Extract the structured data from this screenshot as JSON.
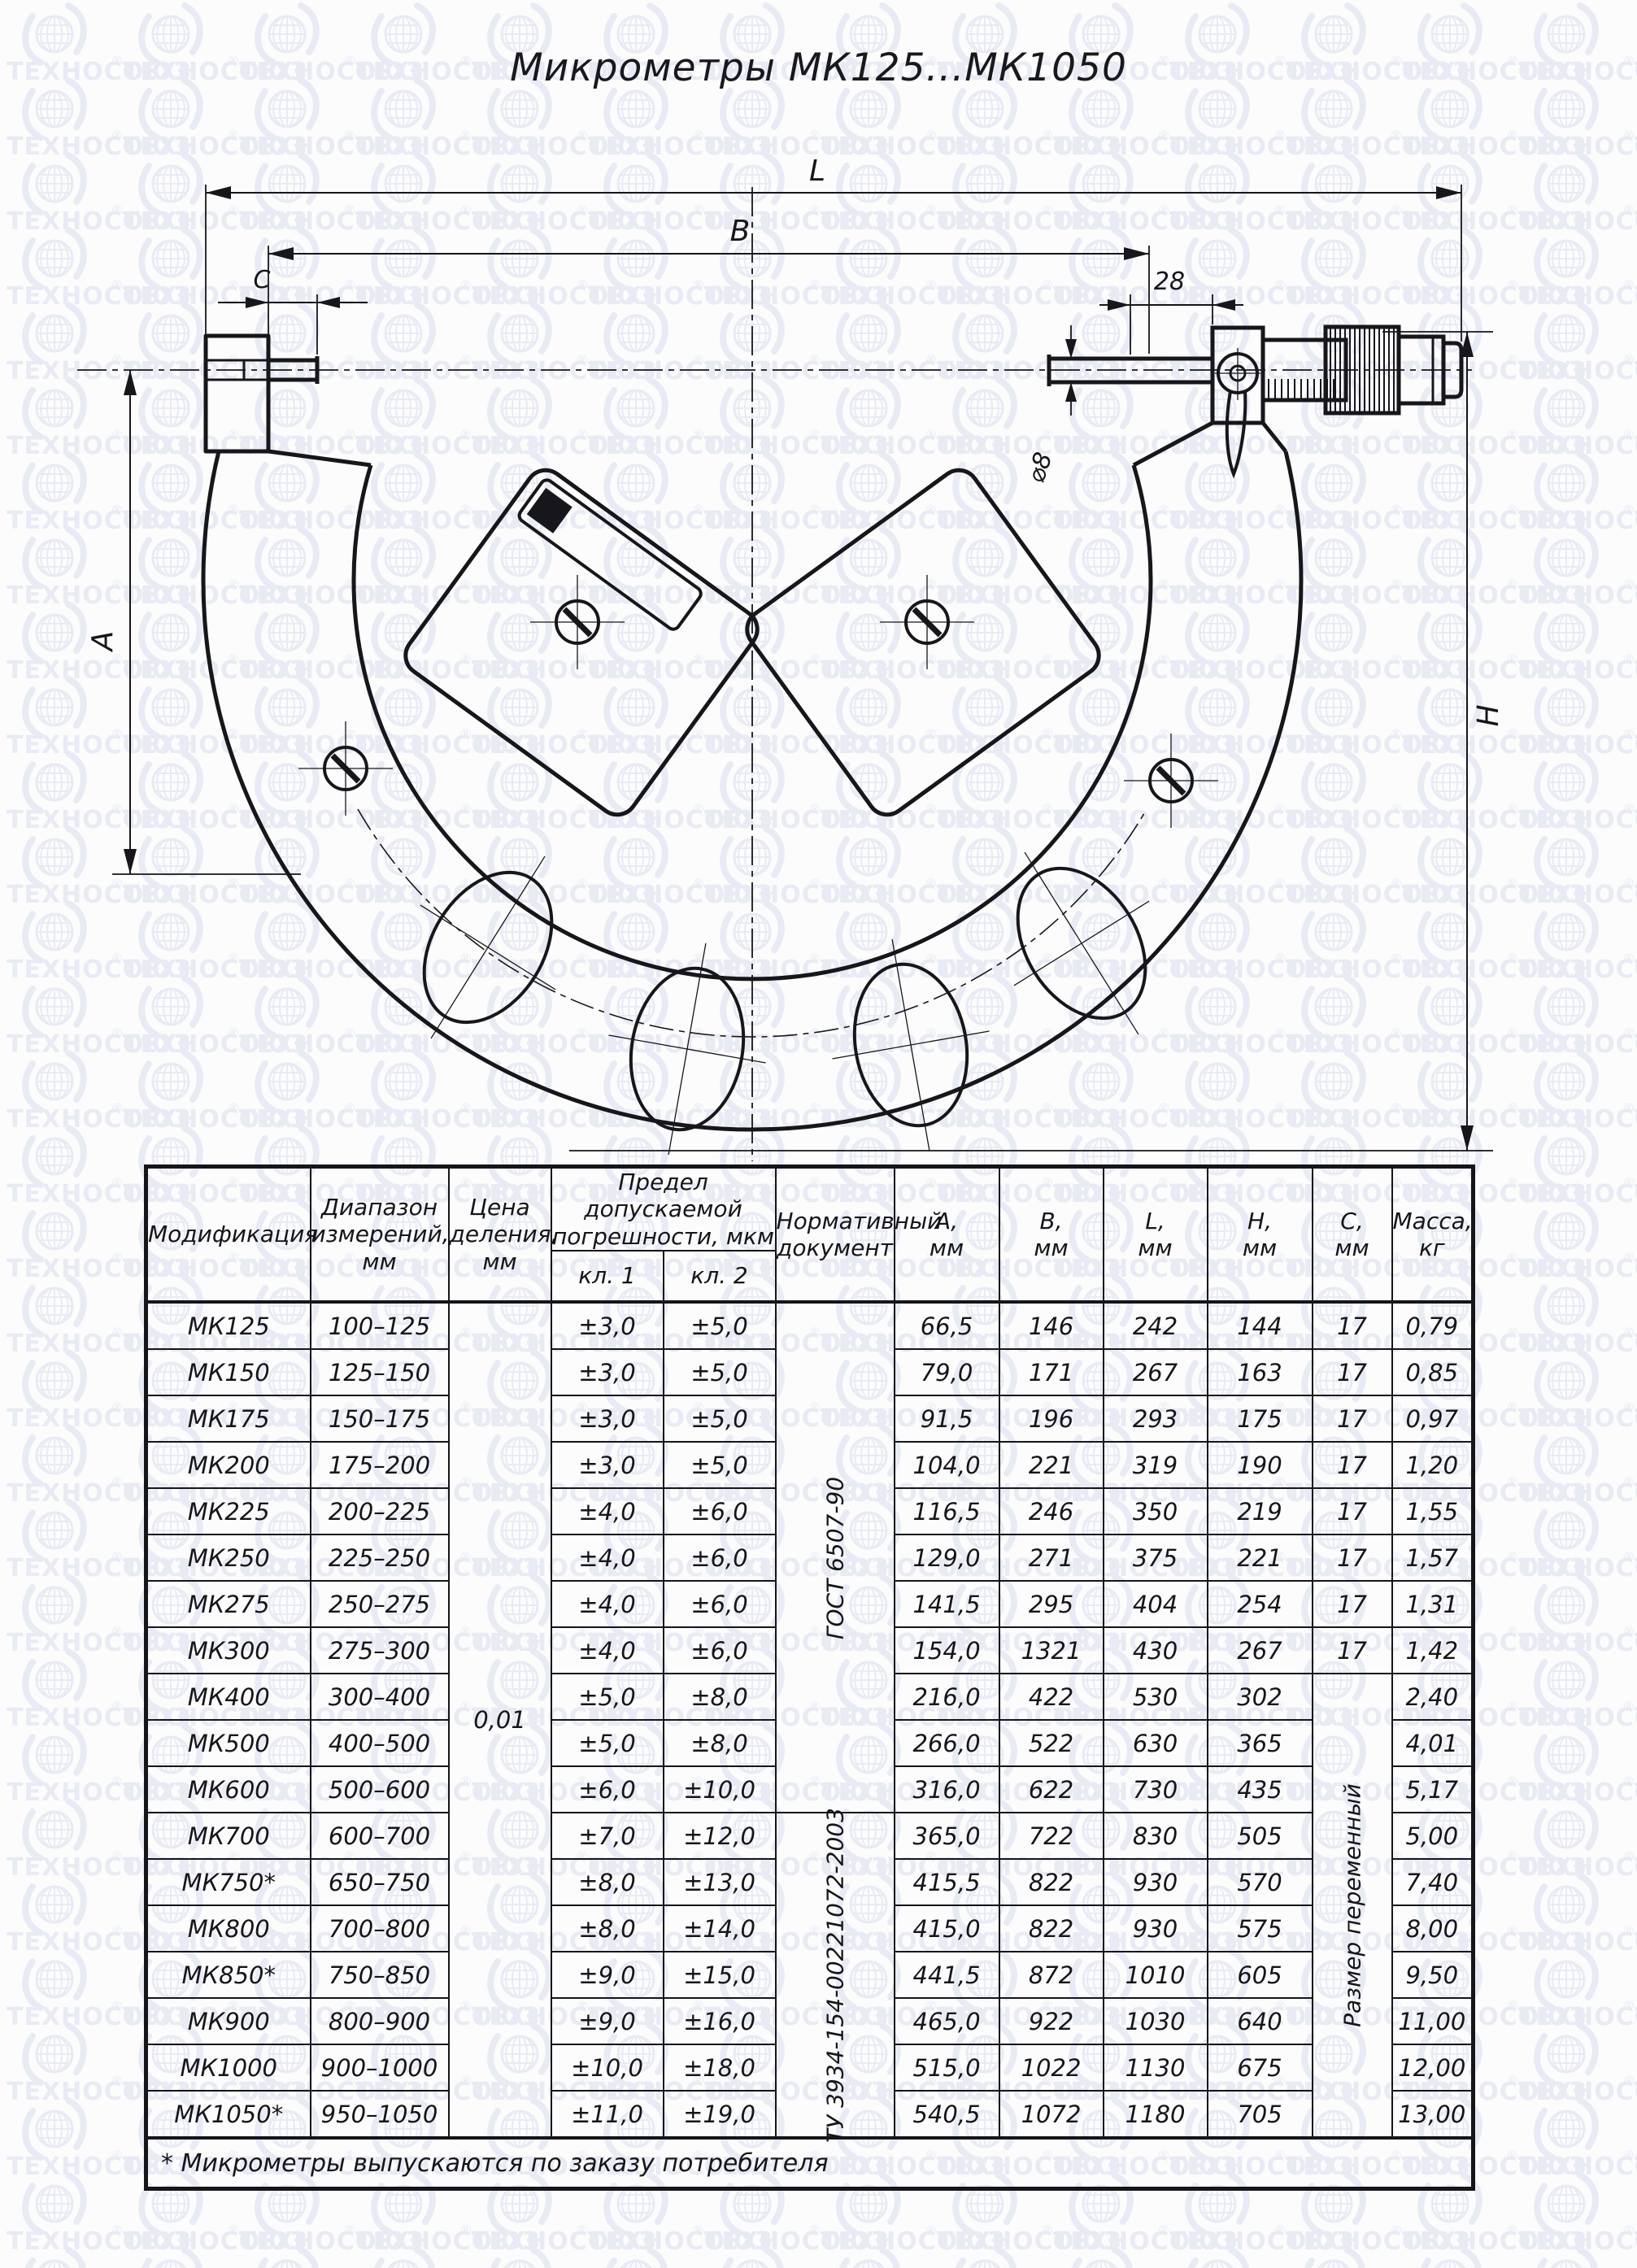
{
  "watermark": {
    "text": "ТЕХНОСОЮЗ",
    "registered": "®",
    "color": "#e8ebf3"
  },
  "title": "Микрометры МК125...МК1050",
  "drawing": {
    "l_label": "L",
    "b_label": "B",
    "c_label": "C",
    "offset_label": "28",
    "diameter_label": "⌀8",
    "a_label": "A",
    "h_label": "H"
  },
  "table": {
    "headers": {
      "modification": "Модификация",
      "range": "Диапазон\nизмерений,\nмм",
      "division": "Цена\nделения,\nмм",
      "error_group": "Предел допускаемой\nпогрешности, мкм",
      "kl1": "кл. 1",
      "kl2": "кл. 2",
      "document": "Нормативный\nдокумент",
      "a": "А,\nмм",
      "b": "В,\nмм",
      "l": "L,\nмм",
      "h": "Н,\nмм",
      "c": "С,\nмм",
      "mass": "Масса,\nкг"
    },
    "merged": {
      "division_value": "0,01",
      "doc1": "ГОСТ 6507-90",
      "doc2": "ТУ 3934-154-00221072-2003",
      "c_variable": "Размер переменный"
    },
    "rows": [
      {
        "model": "МК125",
        "range": "100–125",
        "kl1": "±3,0",
        "kl2": "±5,0",
        "a": "66,5",
        "b": "146",
        "l": "242",
        "h": "144",
        "c": "17",
        "mass": "0,79"
      },
      {
        "model": "МК150",
        "range": "125–150",
        "kl1": "±3,0",
        "kl2": "±5,0",
        "a": "79,0",
        "b": "171",
        "l": "267",
        "h": "163",
        "c": "17",
        "mass": "0,85"
      },
      {
        "model": "МК175",
        "range": "150–175",
        "kl1": "±3,0",
        "kl2": "±5,0",
        "a": "91,5",
        "b": "196",
        "l": "293",
        "h": "175",
        "c": "17",
        "mass": "0,97"
      },
      {
        "model": "МК200",
        "range": "175–200",
        "kl1": "±3,0",
        "kl2": "±5,0",
        "a": "104,0",
        "b": "221",
        "l": "319",
        "h": "190",
        "c": "17",
        "mass": "1,20"
      },
      {
        "model": "МК225",
        "range": "200–225",
        "kl1": "±4,0",
        "kl2": "±6,0",
        "a": "116,5",
        "b": "246",
        "l": "350",
        "h": "219",
        "c": "17",
        "mass": "1,55"
      },
      {
        "model": "МК250",
        "range": "225–250",
        "kl1": "±4,0",
        "kl2": "±6,0",
        "a": "129,0",
        "b": "271",
        "l": "375",
        "h": "221",
        "c": "17",
        "mass": "1,57"
      },
      {
        "model": "МК275",
        "range": "250–275",
        "kl1": "±4,0",
        "kl2": "±6,0",
        "a": "141,5",
        "b": "295",
        "l": "404",
        "h": "254",
        "c": "17",
        "mass": "1,31"
      },
      {
        "model": "МК300",
        "range": "275–300",
        "kl1": "±4,0",
        "kl2": "±6,0",
        "a": "154,0",
        "b": "1321",
        "l": "430",
        "h": "267",
        "c": "17",
        "mass": "1,42"
      },
      {
        "model": "МК400",
        "range": "300–400",
        "kl1": "±5,0",
        "kl2": "±8,0",
        "a": "216,0",
        "b": "422",
        "l": "530",
        "h": "302",
        "mass": "2,40"
      },
      {
        "model": "МК500",
        "range": "400–500",
        "kl1": "±5,0",
        "kl2": "±8,0",
        "a": "266,0",
        "b": "522",
        "l": "630",
        "h": "365",
        "mass": "4,01"
      },
      {
        "model": "МК600",
        "range": "500–600",
        "kl1": "±6,0",
        "kl2": "±10,0",
        "a": "316,0",
        "b": "622",
        "l": "730",
        "h": "435",
        "mass": "5,17"
      },
      {
        "model": "МК700",
        "range": "600–700",
        "kl1": "±7,0",
        "kl2": "±12,0",
        "a": "365,0",
        "b": "722",
        "l": "830",
        "h": "505",
        "mass": "5,00"
      },
      {
        "model": "МК750*",
        "range": "650–750",
        "kl1": "±8,0",
        "kl2": "±13,0",
        "a": "415,5",
        "b": "822",
        "l": "930",
        "h": "570",
        "mass": "7,40"
      },
      {
        "model": "МК800",
        "range": "700–800",
        "kl1": "±8,0",
        "kl2": "±14,0",
        "a": "415,0",
        "b": "822",
        "l": "930",
        "h": "575",
        "mass": "8,00"
      },
      {
        "model": "МК850*",
        "range": "750–850",
        "kl1": "±9,0",
        "kl2": "±15,0",
        "a": "441,5",
        "b": "872",
        "l": "1010",
        "h": "605",
        "mass": "9,50"
      },
      {
        "model": "МК900",
        "range": "800–900",
        "kl1": "±9,0",
        "kl2": "±16,0",
        "a": "465,0",
        "b": "922",
        "l": "1030",
        "h": "640",
        "mass": "11,00"
      },
      {
        "model": "МК1000",
        "range": "900–1000",
        "kl1": "±10,0",
        "kl2": "±18,0",
        "a": "515,0",
        "b": "1022",
        "l": "1130",
        "h": "675",
        "mass": "12,00"
      },
      {
        "model": "МК1050*",
        "range": "950–1050",
        "kl1": "±11,0",
        "kl2": "±19,0",
        "a": "540,5",
        "b": "1072",
        "l": "1180",
        "h": "705",
        "mass": "13,00"
      }
    ],
    "footnote": "* Микрометры выпускаются по заказу потребителя"
  }
}
